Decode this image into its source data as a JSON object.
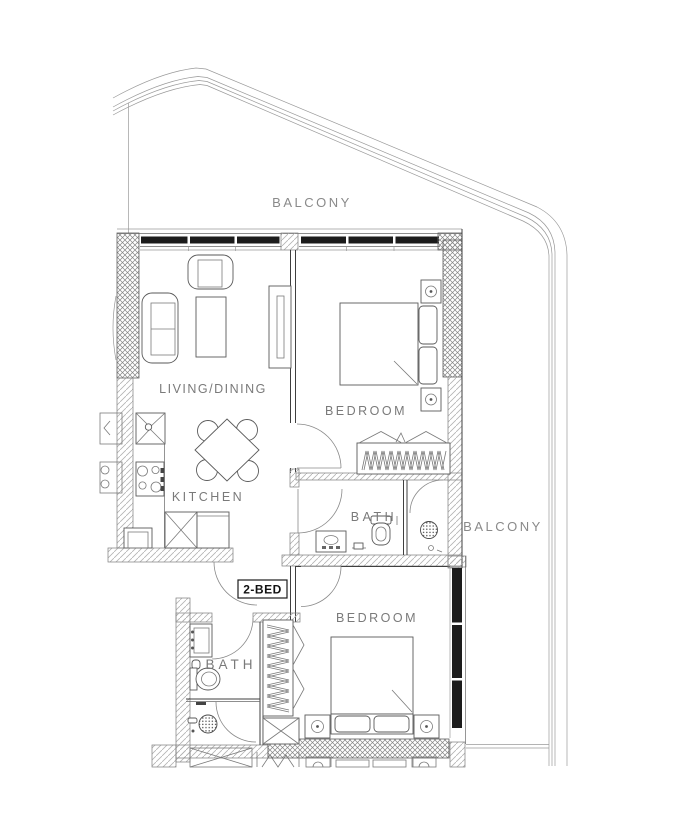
{
  "document": {
    "kind": "apartment floor plan drawing",
    "unit_type_badge": "2-BED"
  },
  "labels": {
    "balcony_top": "BALCONY",
    "balcony_right": "BALCONY",
    "living_dining": "LIVING/DINING",
    "bedroom_top": "BEDROOM",
    "bedroom_bottom": "BEDROOM",
    "kitchen": "KITCHEN",
    "bath_top": "BATH",
    "bath_bottom": "BATH",
    "unit_type": "2-BED"
  },
  "colors": {
    "background": "#ffffff",
    "wall_line": "#3f3f3f",
    "furniture_line": "#5a5a5a",
    "window_frame_fill": "#1c1c1c",
    "hatch_gray": "#9a9a9a",
    "room_label_text": "#7a7a7a",
    "unit_tag_text": "#111111"
  }
}
